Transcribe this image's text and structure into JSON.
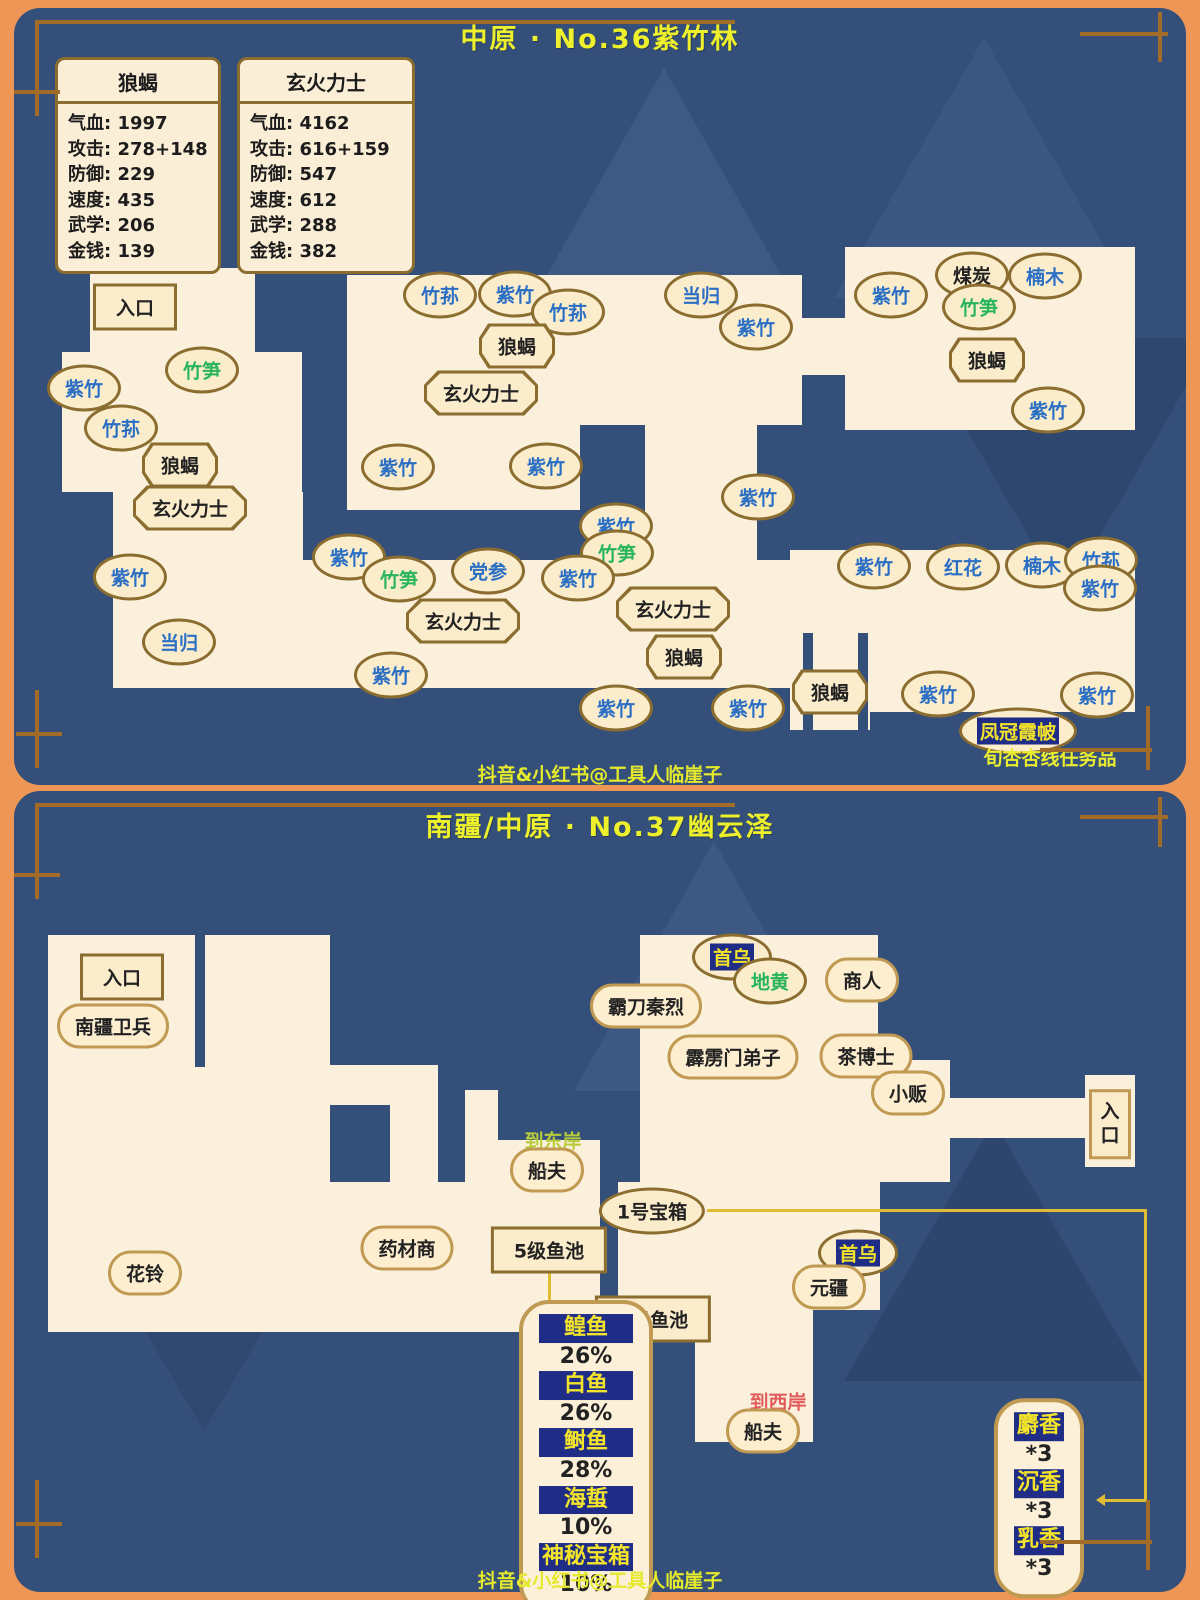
{
  "panel1": {
    "title": "中原 · No.36紫竹林",
    "watermark": "抖音&小红书@工具人临崖子",
    "stat_cards": [
      {
        "title": "狼蝎",
        "x": 55,
        "y": 57,
        "w": 160,
        "rows": [
          [
            "气血",
            "1997"
          ],
          [
            "攻击",
            "278+148"
          ],
          [
            "防御",
            "229"
          ],
          [
            "速度",
            "435"
          ],
          [
            "武学",
            "206"
          ],
          [
            "金钱",
            "139"
          ]
        ]
      },
      {
        "title": "玄火力士",
        "x": 237,
        "y": 57,
        "w": 172,
        "rows": [
          [
            "气血",
            "4162"
          ],
          [
            "攻击",
            "616+159"
          ],
          [
            "防御",
            "547"
          ],
          [
            "速度",
            "612"
          ],
          [
            "武学",
            "288"
          ],
          [
            "金钱",
            "382"
          ]
        ]
      }
    ],
    "map_rects": [
      [
        90,
        268,
        165,
        90
      ],
      [
        62,
        352,
        240,
        140
      ],
      [
        113,
        492,
        190,
        196
      ],
      [
        347,
        275,
        455,
        150
      ],
      [
        347,
        425,
        233,
        85
      ],
      [
        645,
        425,
        112,
        137
      ],
      [
        280,
        560,
        522,
        128
      ],
      [
        800,
        318,
        50,
        57
      ],
      [
        845,
        247,
        290,
        183
      ],
      [
        790,
        550,
        345,
        55
      ],
      [
        845,
        605,
        290,
        107
      ],
      [
        790,
        605,
        80,
        125
      ]
    ],
    "cutouts": [
      [
        803,
        633,
        10,
        97
      ],
      [
        858,
        633,
        10,
        97
      ]
    ],
    "labels": [
      {
        "t": "入口",
        "k": "rect",
        "c": "black",
        "x": 135,
        "y": 307
      },
      {
        "t": "竹笋",
        "k": "oval",
        "c": "green",
        "x": 202,
        "y": 370
      },
      {
        "t": "紫竹",
        "k": "oval",
        "c": "blue",
        "x": 84,
        "y": 388
      },
      {
        "t": "竹荪",
        "k": "oval",
        "c": "blue",
        "x": 121,
        "y": 428
      },
      {
        "t": "狼蝎",
        "k": "octo",
        "c": "black",
        "x": 180,
        "y": 465
      },
      {
        "t": "玄火力士",
        "k": "octo",
        "c": "black",
        "x": 190,
        "y": 508
      },
      {
        "t": "紫竹",
        "k": "oval",
        "c": "blue",
        "x": 130,
        "y": 577
      },
      {
        "t": "当归",
        "k": "oval",
        "c": "blue",
        "x": 179,
        "y": 642
      },
      {
        "t": "紫竹",
        "k": "oval",
        "c": "blue",
        "x": 391,
        "y": 675
      },
      {
        "t": "竹荪",
        "k": "oval",
        "c": "blue",
        "x": 440,
        "y": 295
      },
      {
        "t": "紫竹",
        "k": "oval",
        "c": "blue",
        "x": 515,
        "y": 294
      },
      {
        "t": "竹荪",
        "k": "oval",
        "c": "blue",
        "x": 568,
        "y": 312
      },
      {
        "t": "狼蝎",
        "k": "octo",
        "c": "black",
        "x": 517,
        "y": 346
      },
      {
        "t": "玄火力士",
        "k": "octo",
        "c": "black",
        "x": 481,
        "y": 393
      },
      {
        "t": "紫竹",
        "k": "oval",
        "c": "blue",
        "x": 398,
        "y": 467
      },
      {
        "t": "紫竹",
        "k": "oval",
        "c": "blue",
        "x": 546,
        "y": 466
      },
      {
        "t": "当归",
        "k": "oval",
        "c": "blue",
        "x": 701,
        "y": 295
      },
      {
        "t": "紫竹",
        "k": "oval",
        "c": "blue",
        "x": 756,
        "y": 327
      },
      {
        "t": "紫竹",
        "k": "oval",
        "c": "blue",
        "x": 758,
        "y": 497
      },
      {
        "t": "紫竹",
        "k": "oval",
        "c": "blue",
        "x": 616,
        "y": 526
      },
      {
        "t": "竹笋",
        "k": "oval",
        "c": "green",
        "x": 617,
        "y": 553
      },
      {
        "t": "紫竹",
        "k": "oval",
        "c": "blue",
        "x": 349,
        "y": 557
      },
      {
        "t": "竹笋",
        "k": "oval",
        "c": "green",
        "x": 399,
        "y": 579
      },
      {
        "t": "党参",
        "k": "oval",
        "c": "blue",
        "x": 488,
        "y": 571
      },
      {
        "t": "紫竹",
        "k": "oval",
        "c": "blue",
        "x": 578,
        "y": 578
      },
      {
        "t": "玄火力士",
        "k": "octo",
        "c": "black",
        "x": 463,
        "y": 621
      },
      {
        "t": "玄火力士",
        "k": "octo",
        "c": "black",
        "x": 673,
        "y": 609
      },
      {
        "t": "狼蝎",
        "k": "octo",
        "c": "black",
        "x": 684,
        "y": 657
      },
      {
        "t": "紫竹",
        "k": "oval",
        "c": "blue",
        "x": 616,
        "y": 708
      },
      {
        "t": "紫竹",
        "k": "oval",
        "c": "blue",
        "x": 748,
        "y": 708
      },
      {
        "t": "狼蝎",
        "k": "octo",
        "c": "black",
        "x": 830,
        "y": 692
      },
      {
        "t": "紫竹",
        "k": "oval",
        "c": "blue",
        "x": 938,
        "y": 694
      },
      {
        "t": "紫竹",
        "k": "oval",
        "c": "blue",
        "x": 1097,
        "y": 695
      },
      {
        "t": "凤冠霞帔",
        "k": "oval",
        "c": "hl",
        "x": 1018,
        "y": 731
      },
      {
        "t": "旬杏杏线任务品",
        "k": "text",
        "c": "yellow",
        "x": 1050,
        "y": 757
      },
      {
        "t": "紫竹",
        "k": "oval",
        "c": "blue",
        "x": 891,
        "y": 295
      },
      {
        "t": "煤炭",
        "k": "oval",
        "c": "black",
        "x": 972,
        "y": 275
      },
      {
        "t": "楠木",
        "k": "oval",
        "c": "blue",
        "x": 1045,
        "y": 276
      },
      {
        "t": "竹笋",
        "k": "oval",
        "c": "green",
        "x": 979,
        "y": 307
      },
      {
        "t": "狼蝎",
        "k": "octo",
        "c": "black",
        "x": 987,
        "y": 360
      },
      {
        "t": "紫竹",
        "k": "oval",
        "c": "blue",
        "x": 1048,
        "y": 410
      },
      {
        "t": "紫竹",
        "k": "oval",
        "c": "blue",
        "x": 874,
        "y": 566
      },
      {
        "t": "红花",
        "k": "oval",
        "c": "blue",
        "x": 963,
        "y": 567
      },
      {
        "t": "楠木",
        "k": "oval",
        "c": "blue",
        "x": 1042,
        "y": 565
      },
      {
        "t": "竹荪",
        "k": "oval",
        "c": "blue",
        "x": 1101,
        "y": 560
      },
      {
        "t": "紫竹",
        "k": "oval",
        "c": "blue",
        "x": 1100,
        "y": 588
      }
    ]
  },
  "panel2": {
    "title": "南疆/中原 · No.37幽云泽",
    "watermark": "抖音&小红书@工具人临崖子",
    "map_rects": [
      [
        48,
        935,
        282,
        247
      ],
      [
        330,
        1065,
        60,
        40
      ],
      [
        390,
        1065,
        48,
        117
      ],
      [
        48,
        1182,
        552,
        150
      ],
      [
        465,
        1090,
        33,
        110
      ],
      [
        465,
        1140,
        135,
        60
      ],
      [
        640,
        935,
        238,
        150
      ],
      [
        640,
        1060,
        310,
        122
      ],
      [
        618,
        1182,
        262,
        128
      ],
      [
        695,
        1310,
        118,
        132
      ],
      [
        918,
        1098,
        170,
        40
      ],
      [
        1085,
        1075,
        50,
        92
      ]
    ],
    "cutouts": [
      [
        195,
        935,
        10,
        132
      ]
    ],
    "labels": [
      {
        "t": "入口",
        "k": "rect",
        "c": "black",
        "x": 122,
        "y": 977
      },
      {
        "t": "南疆卫兵",
        "k": "capsule",
        "c": "black",
        "x": 113,
        "y": 1026
      },
      {
        "t": "首乌",
        "k": "oval",
        "c": "hl",
        "x": 732,
        "y": 957
      },
      {
        "t": "地黄",
        "k": "oval",
        "c": "green",
        "x": 770,
        "y": 981
      },
      {
        "t": "商人",
        "k": "capsule",
        "c": "black",
        "x": 862,
        "y": 980
      },
      {
        "t": "霸刀秦烈",
        "k": "capsule",
        "c": "black",
        "x": 646,
        "y": 1006
      },
      {
        "t": "霹雳门弟子",
        "k": "capsule",
        "c": "black",
        "x": 733,
        "y": 1057
      },
      {
        "t": "茶博士",
        "k": "capsule",
        "c": "black",
        "x": 866,
        "y": 1056
      },
      {
        "t": "小贩",
        "k": "capsule",
        "c": "black",
        "x": 908,
        "y": 1093
      },
      {
        "t": "到东岸",
        "k": "text",
        "c": "yg",
        "x": 553,
        "y": 1140
      },
      {
        "t": "船夫",
        "k": "capsule",
        "c": "black",
        "x": 547,
        "y": 1170
      },
      {
        "t": "1号宝箱",
        "k": "oval",
        "c": "black",
        "x": 652,
        "y": 1211
      },
      {
        "t": "5级鱼池",
        "k": "rect",
        "c": "black",
        "x": 549,
        "y": 1250
      },
      {
        "t": "首乌",
        "k": "oval",
        "c": "hl",
        "x": 858,
        "y": 1253
      },
      {
        "t": "元疆",
        "k": "capsule",
        "c": "black",
        "x": 829,
        "y": 1287
      },
      {
        "t": "药材商",
        "k": "capsule",
        "c": "black",
        "x": 407,
        "y": 1248
      },
      {
        "t": "花铃",
        "k": "capsule",
        "c": "black",
        "x": 145,
        "y": 1273
      },
      {
        "t": "5级鱼池",
        "k": "rect",
        "c": "black",
        "x": 653,
        "y": 1319
      },
      {
        "t": "到西岸",
        "k": "text",
        "c": "red",
        "x": 778,
        "y": 1401
      },
      {
        "t": "船夫",
        "k": "capsule",
        "c": "black",
        "x": 763,
        "y": 1431
      },
      {
        "t": "入口",
        "k": "vrect",
        "c": "black",
        "x": 1110,
        "y": 1124
      }
    ],
    "fish_box": {
      "x": 586,
      "y": 1457,
      "rows": [
        [
          "鳇鱼",
          "26%"
        ],
        [
          "白鱼",
          "26%"
        ],
        [
          "鲥鱼",
          "28%"
        ],
        [
          "海蜇",
          "10%"
        ],
        [
          "神秘宝箱",
          "10%"
        ]
      ]
    },
    "incense_box": {
      "x": 1039,
      "y": 1498,
      "rows": [
        [
          "麝香",
          "*3"
        ],
        [
          "沉香",
          "*3"
        ],
        [
          "乳香",
          "*3"
        ]
      ]
    }
  }
}
